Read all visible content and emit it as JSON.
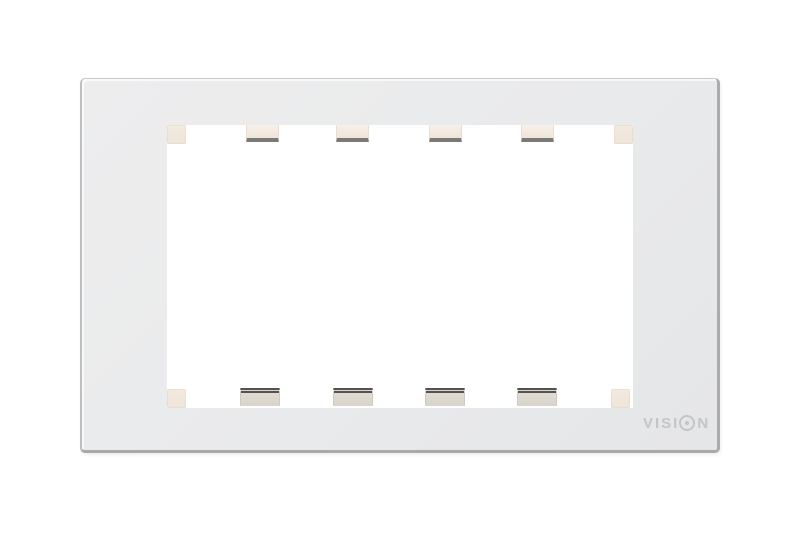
{
  "product": {
    "kind": "faceplate-frame-photo",
    "brand_logo": {
      "full_text": "VISION",
      "prefix": "VISI",
      "suffix": "N",
      "color": "#c3c5c7"
    },
    "colors": {
      "plate": "#e9eaeb",
      "plate_edge": "#a9abad",
      "aperture": "#ffffff",
      "corner_tab": "#f1e8de",
      "top_clip": "#f5ede4",
      "bottom_clip": "#dcd7cf",
      "clip_line": "#55534f"
    },
    "hardware": {
      "corner_tabs": 4,
      "top_clips": 4,
      "bottom_clips": 4
    }
  }
}
